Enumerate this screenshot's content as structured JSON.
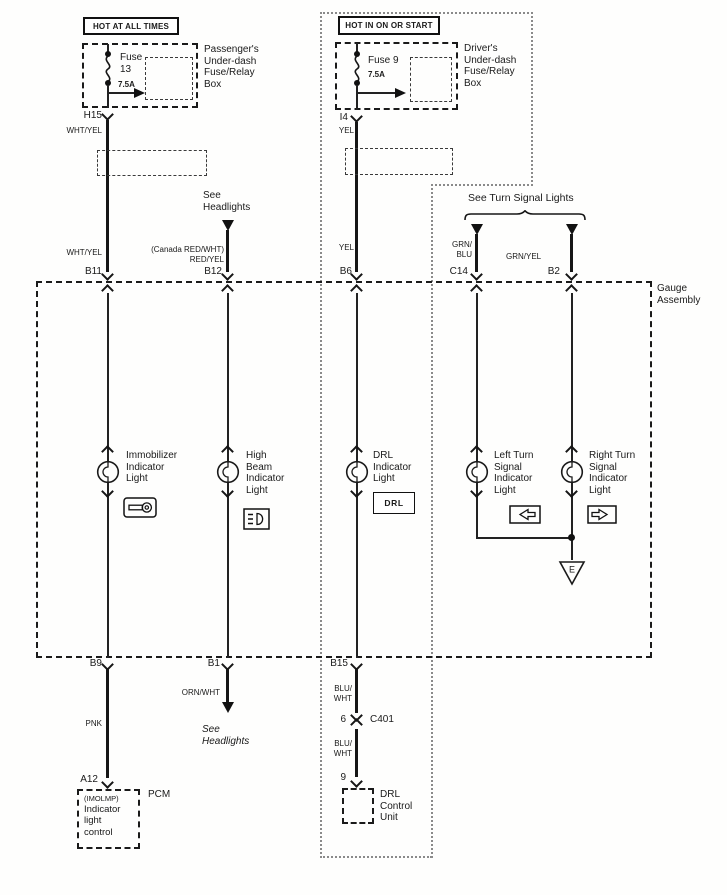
{
  "power": {
    "left": {
      "header": "HOT AT ALL TIMES",
      "fuse": "Fuse\n13",
      "rating": "7.5A",
      "box": "Passenger's\nUnder-dash\nFuse/Relay\nBox",
      "pin": "H15",
      "wire1": "WHT/YEL",
      "wire2": "WHT/YEL",
      "gauge_pin": "B11"
    },
    "right": {
      "header": "HOT IN ON OR START",
      "fuse": "Fuse 9",
      "rating": "7.5A",
      "box": "Driver's\nUnder-dash\nFuse/Relay\nBox",
      "pin": "I4",
      "wire1": "YEL",
      "wire2": "YEL",
      "gauge_pin": "B6"
    }
  },
  "headlight_feed": {
    "note": "See\nHeadlights",
    "wire": "(Canada RED/WHT)\nRED/YEL",
    "gauge_pin": "B12"
  },
  "turn_feed": {
    "note": "See Turn Signal Lights",
    "left_wire": "GRN/\nBLU",
    "left_pin": "C14",
    "right_wire": "GRN/YEL",
    "right_pin": "B2"
  },
  "gauge": {
    "label": "Gauge\nAssembly",
    "indicators": [
      {
        "label": "Immobilizer\nIndicator\nLight",
        "icon": "key-icon"
      },
      {
        "label": "High\nBeam\nIndicator\nLight",
        "icon": "high-beam-icon"
      },
      {
        "label": "DRL\nIndicator\nLight",
        "icon": "drl-badge",
        "badge": "DRL"
      },
      {
        "label": "Left Turn\nSignal\nIndicator\nLight",
        "icon": "left-arrow-icon"
      },
      {
        "label": "Right Turn\nSignal\nIndicator\nLight",
        "icon": "right-arrow-icon"
      }
    ],
    "ground_label": "E"
  },
  "outputs": {
    "pcm": {
      "gauge_pin": "B9",
      "wire": "PNK",
      "pin": "A12",
      "imolmp": "(IMOLMP)",
      "control": "Indicator\nlight\ncontrol",
      "tag": "PCM"
    },
    "headlights": {
      "gauge_pin": "B1",
      "wire": "ORN/WHT",
      "note": "See\nHeadlights"
    },
    "drl": {
      "gauge_pin": "B15",
      "wire1": "BLU/\nWHT",
      "pin6": "6",
      "connector": "C401",
      "wire2": "BLU/\nWHT",
      "pin9": "9",
      "unit": "DRL\nControl\nUnit"
    }
  }
}
